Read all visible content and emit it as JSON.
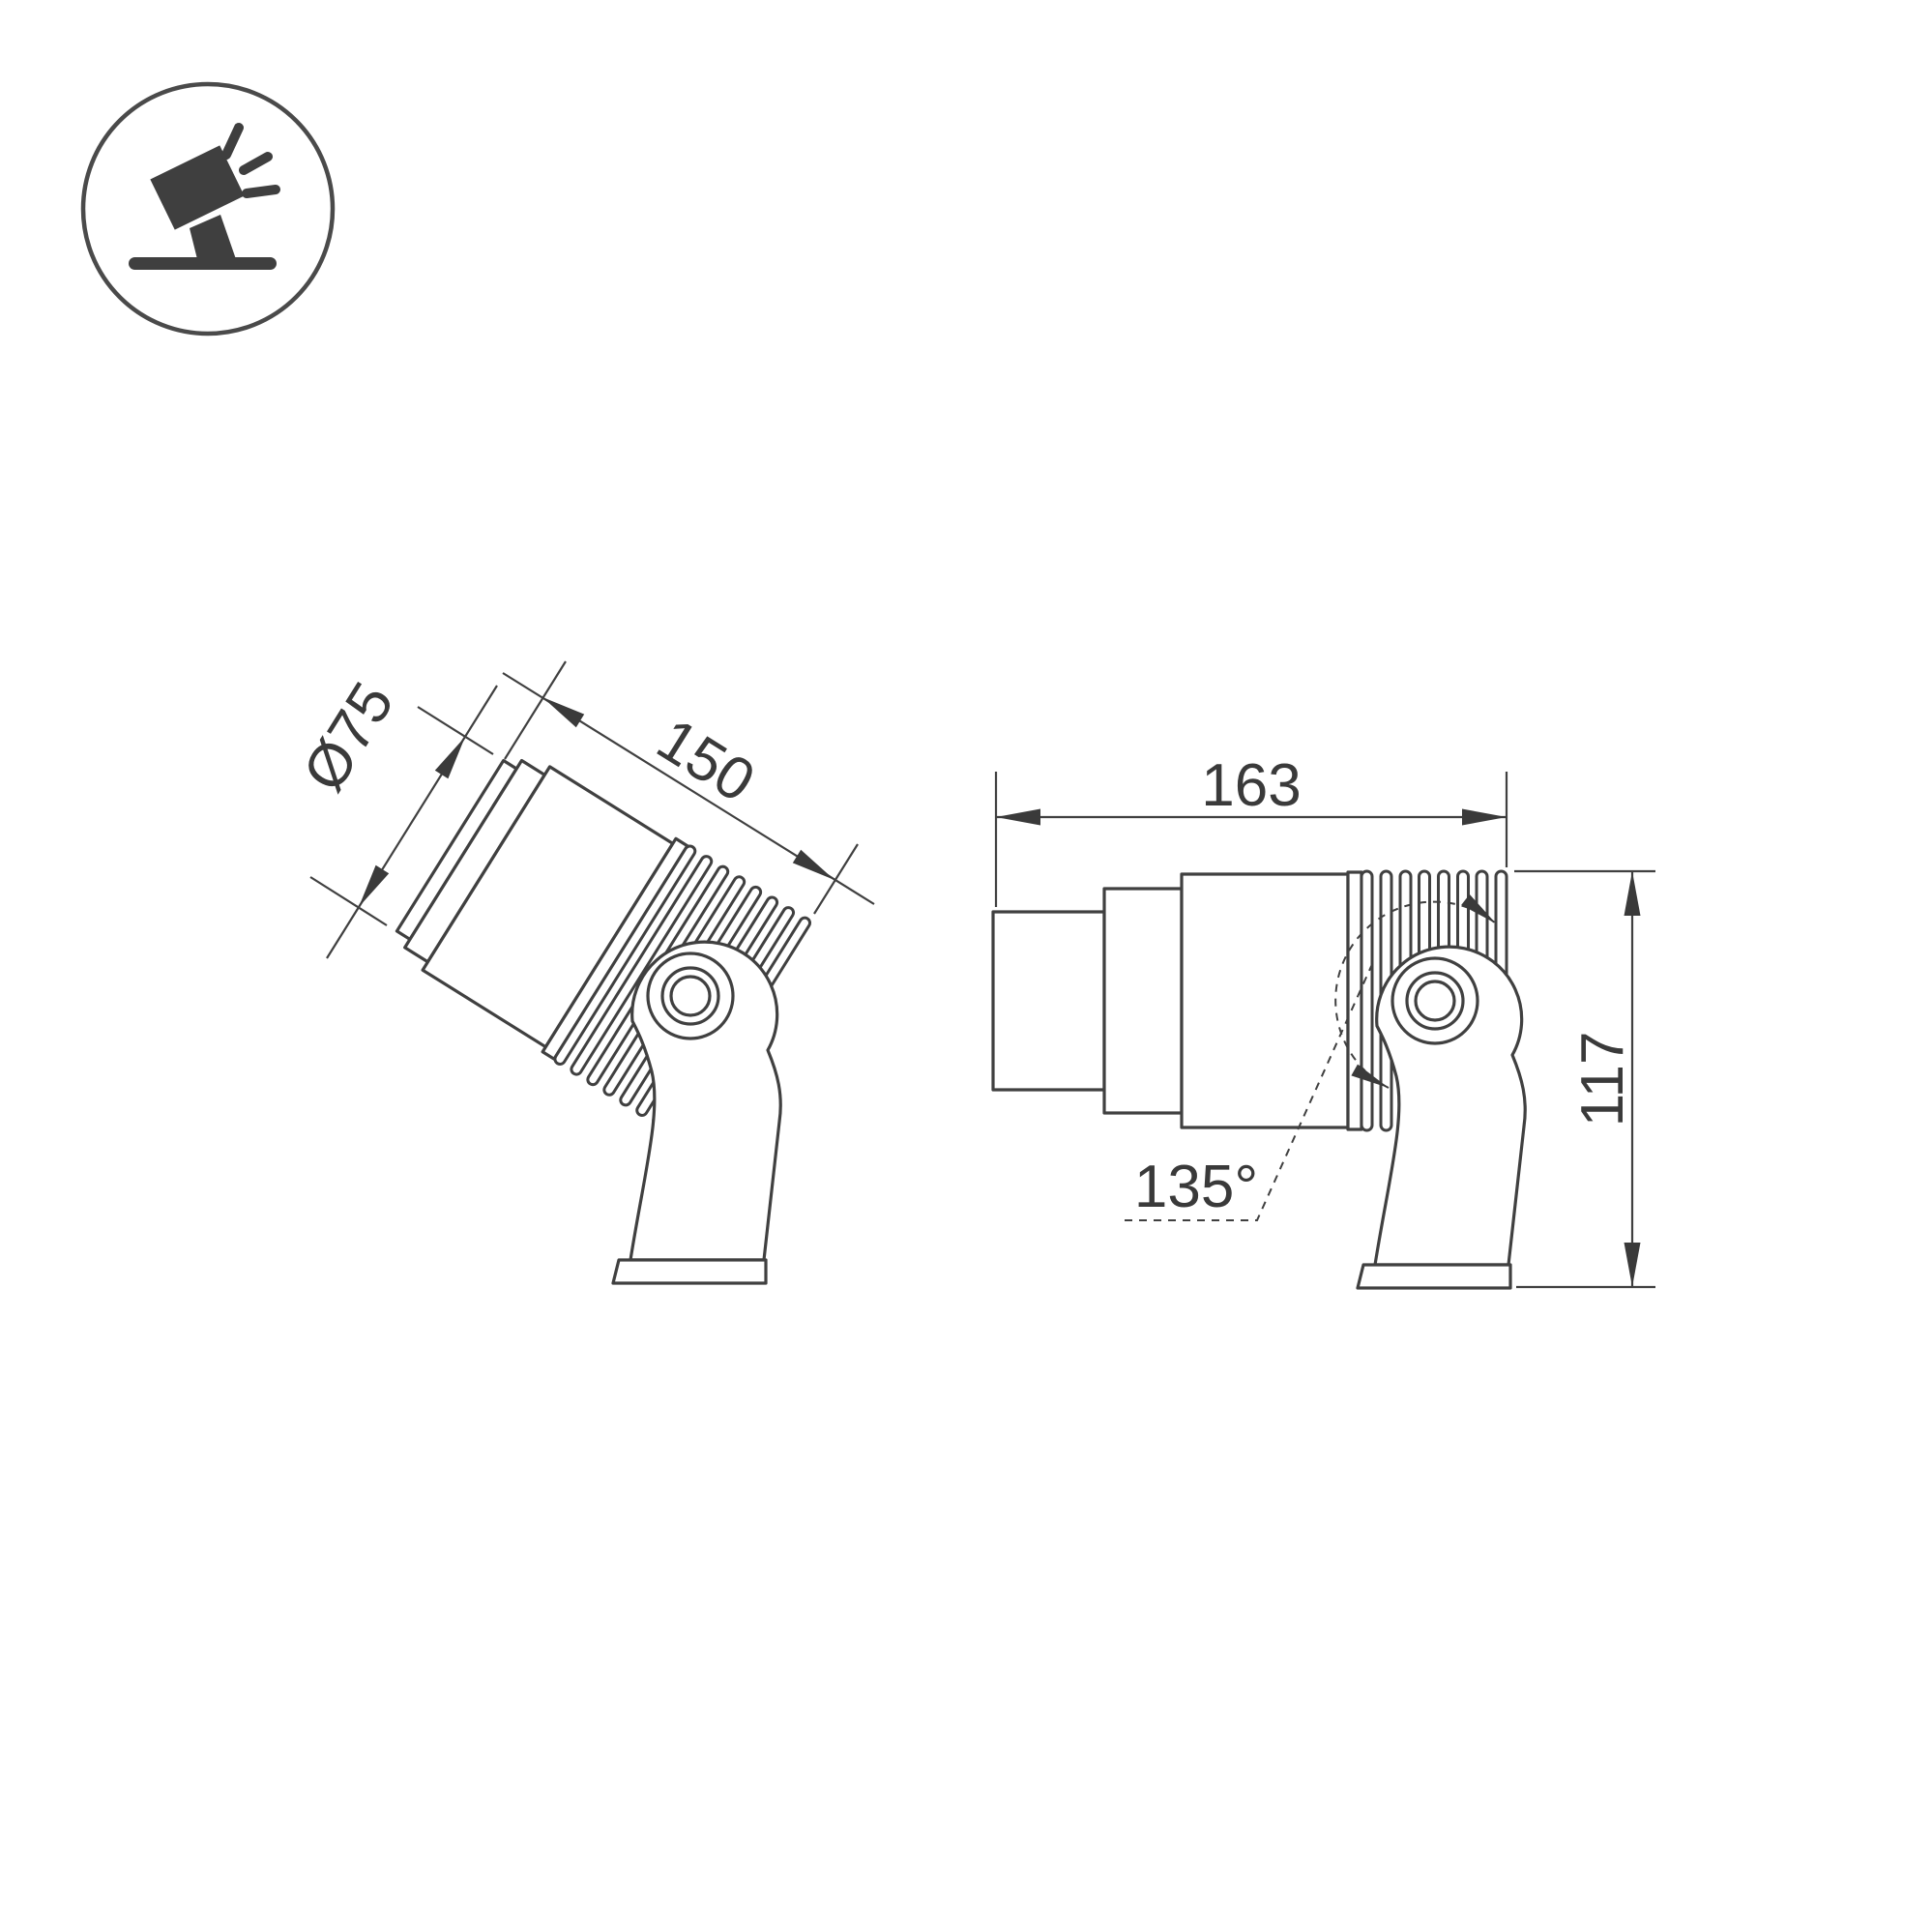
{
  "page": {
    "background_color": "#ffffff",
    "line_color": "#404040",
    "text_color": "#3a3a3a"
  },
  "icon": {
    "name": "tilted-spotlight-on-base"
  },
  "drawing": {
    "left_view": {
      "description": "spotlight tilted on mounting bracket",
      "diameter_label": "Ø75",
      "length_label": "150"
    },
    "right_view": {
      "description": "spotlight horizontal on mounting bracket",
      "length_label": "163",
      "height_label": "117",
      "angle_label": "135°"
    }
  }
}
